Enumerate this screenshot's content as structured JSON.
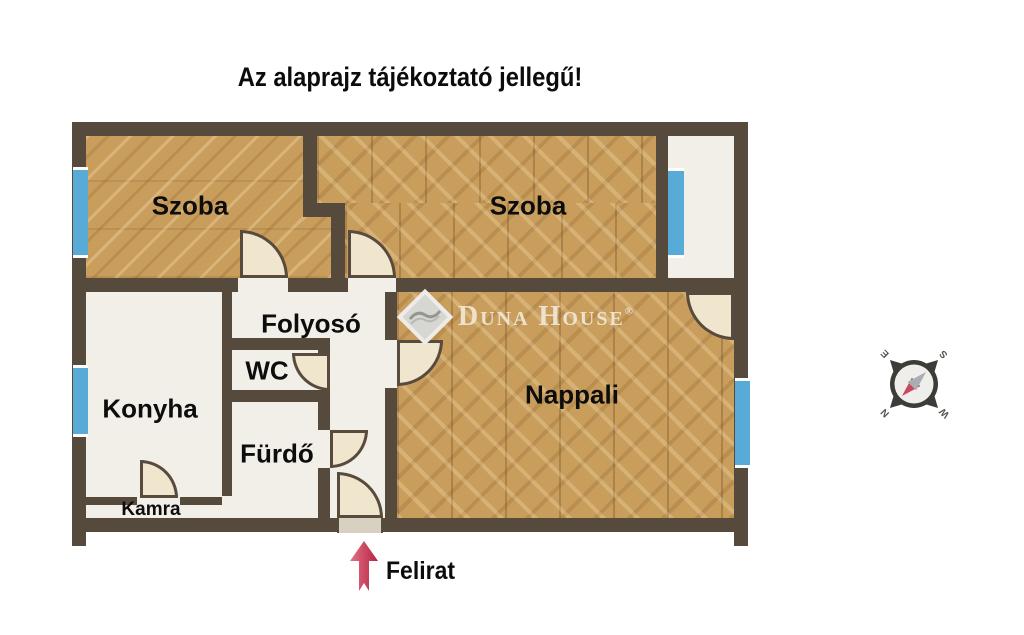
{
  "title": "Az alaprajz tájékoztató jellegű!",
  "watermark": {
    "brand": "Duna House",
    "registered": "®"
  },
  "rooms": {
    "szoba_left": "Szoba",
    "szoba_right": "Szoba",
    "folyoso": "Folyosó",
    "wc": "WC",
    "konyha": "Konyha",
    "furdo": "Fürdő",
    "kamra": "Kamra",
    "nappali": "Nappali"
  },
  "legend": {
    "label": "Felirat"
  },
  "compass": {
    "north": "N",
    "east": "E",
    "south": "S",
    "west": "W"
  },
  "colors": {
    "wall": "#564a3c",
    "parquet": "#c99e5c",
    "floor": "#f2efe9",
    "window_blue": "#58abd7",
    "door_fill": "#f0e5cd",
    "arrow_red": "#c0314f"
  }
}
